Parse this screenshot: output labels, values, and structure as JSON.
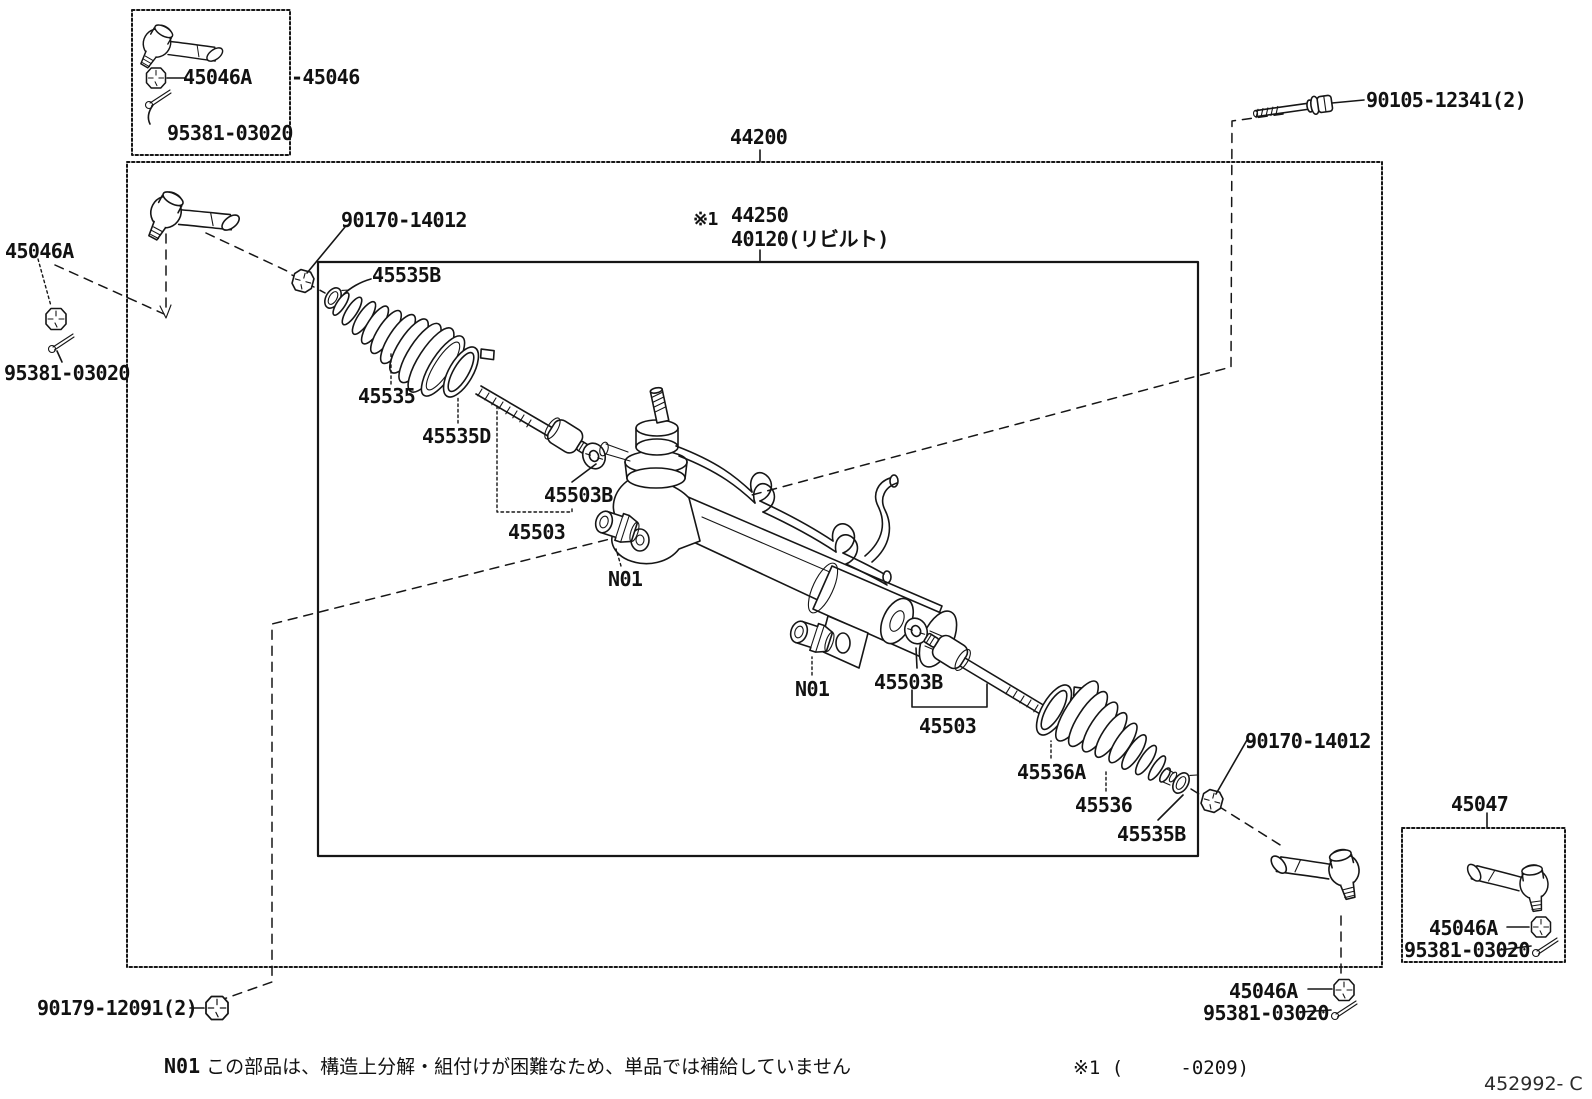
{
  "colors": {
    "ink": "#161616",
    "paper": "#ffffff"
  },
  "labels": {
    "tlb_part": "45046A",
    "tlb_group": "-45046",
    "tlb_pin": "95381-03020",
    "l_nut": "45046A",
    "l_pin": "95381-03020",
    "grom_l": "90170-14012",
    "smclamp_l": "45535B",
    "boot_l": "45535",
    "bigclamp_l": "45535D",
    "washer_l": "45503B",
    "rod_l": "45503",
    "n01a": "N01",
    "n01b": "N01",
    "washer_r": "45503B",
    "rod_r": "45503",
    "bigclamp_r": "45536A",
    "boot_r": "45536",
    "smclamp_r": "45535B",
    "grom_r": "90170-14012",
    "assembly": "44200",
    "ref_mark": "※1",
    "gear_std": "44250",
    "gear_reman": "40120(リビルト)",
    "bolt": "90105-12341(2)",
    "rbox_group": "45047",
    "rbox_nut": "45046A",
    "rbox_pin": "95381-03020",
    "brt_nut": "45046A",
    "brt_pin": "95381-03020",
    "blt_nut": "90179-12091(2)"
  },
  "note": {
    "code": "N01",
    "text": " この部品は、構造上分解・組付けが困難なため、単品では補給していません"
  },
  "footnote": "※1 (     -0209)",
  "doc_code": "452992- C"
}
